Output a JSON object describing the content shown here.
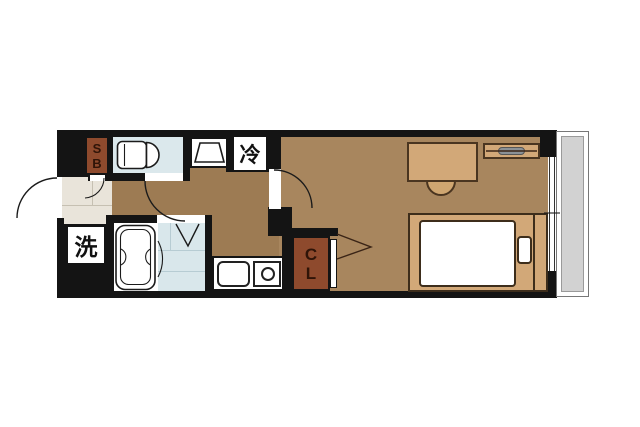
{
  "title": "1K apartment floor plan",
  "labels": {
    "shoe_box": "SB",
    "closet": "CL",
    "refrigerator": "冷",
    "washing_machine": "洗"
  },
  "colors": {
    "wall": "#141414",
    "room_floor": "#a8865e",
    "hallway_floor": "#9d7b53",
    "entrance_floor": "#e9e4da",
    "wet_room": "#dbe8ec",
    "shower_floor": "#d9e7eb",
    "cabinet_brown": "#8e4a2d",
    "furniture_tan": "#d2a878",
    "balcony": "#d2d2d2",
    "tv_gray": "#8b9196"
  },
  "fixtures": [
    "entrance-door",
    "shoe-box",
    "toilet",
    "washbasin",
    "refrigerator-space",
    "washing-machine-space",
    "bathtub",
    "shower-area",
    "kitchen-sink",
    "stove-burner",
    "closet",
    "desk",
    "chair",
    "tv-board",
    "bed",
    "mattress",
    "pillow",
    "window",
    "balcony"
  ]
}
